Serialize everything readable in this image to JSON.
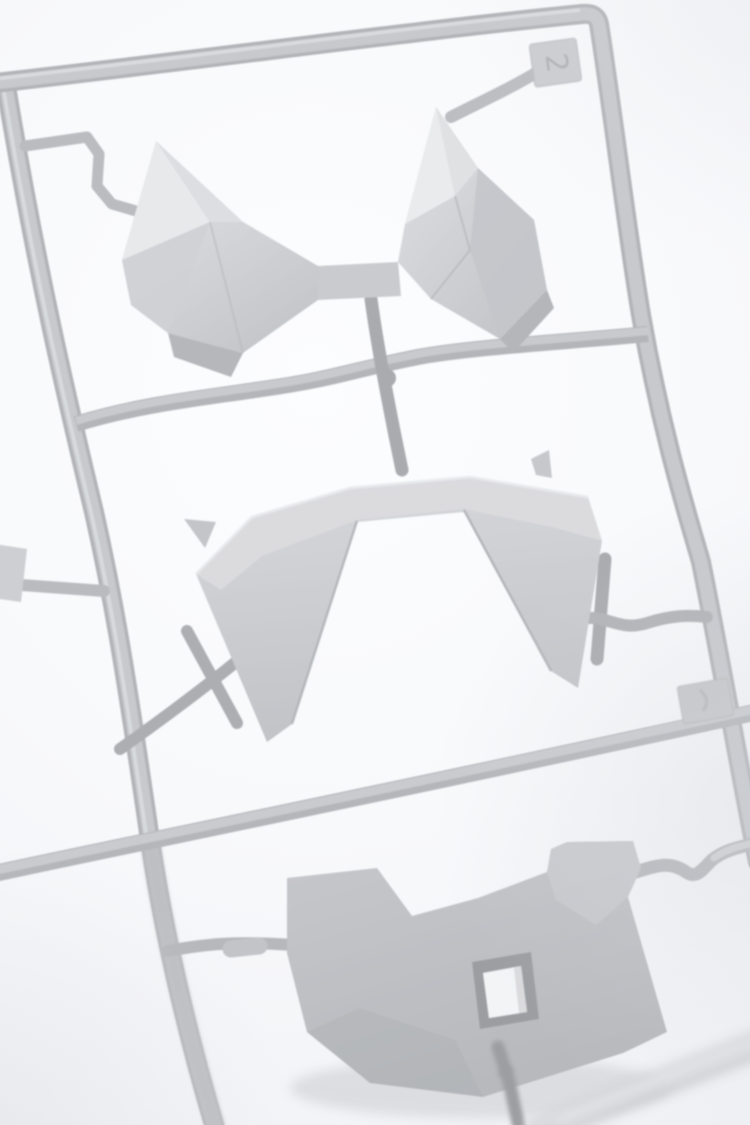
{
  "page": {
    "title": "Plastic model kit sprue photograph"
  },
  "scene": {
    "description": "High-key macro photograph of a light gray plastic model-kit sprue (parts runner) on a bright white background, frame tilted slightly clockwise, shallow depth of field with blurred runners at the bottom edge",
    "parts": [
      {
        "name": "twin-fin crest armor piece",
        "position": "top section"
      },
      {
        "name": "arched visor skirt armor piece",
        "position": "middle section"
      },
      {
        "name": "armor plate with rectangular slot",
        "position": "bottom section"
      }
    ],
    "tabs": [
      {
        "name": "gate number tab",
        "marking": "2",
        "position": "top-right corner of frame"
      },
      {
        "name": "side tab",
        "marking": "",
        "position": "right rail, middle"
      }
    ],
    "colors": {
      "background": "#f8f9fb",
      "vignette": "#e9ebee",
      "plastic_light": "#e8e9eb",
      "plastic_mid": "#c6c8cc",
      "plastic_shadow": "#a8aaae",
      "runner_under": "#b2b4b8",
      "highlight": "#e9eaec",
      "hole_rim": "#9b9da1",
      "hole_interior": "#f3f4f6"
    }
  }
}
